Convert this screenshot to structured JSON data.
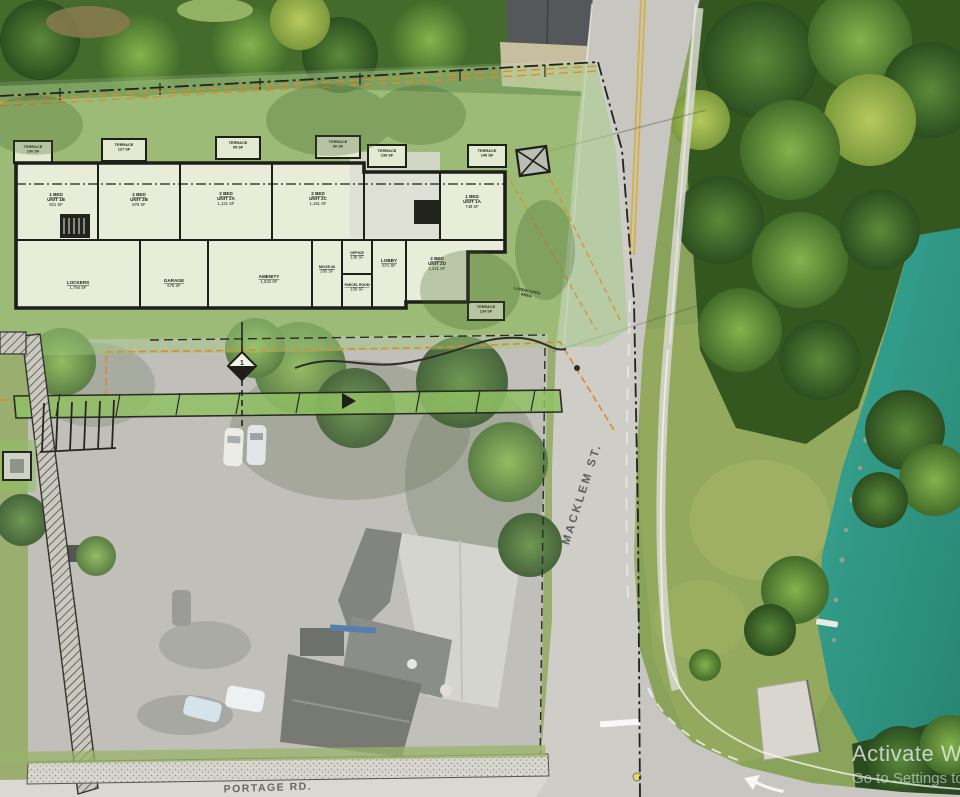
{
  "scene": {
    "description": "Aerial drone view of a riverside site with an architectural site-plan / floor-plan overlay",
    "streets": {
      "macklem": "MACKLEM ST.",
      "portage": "PORTAGE RD."
    },
    "watermark": {
      "line1": "Activate Win",
      "line2": "Go to Settings to"
    }
  },
  "plan": {
    "terraces": [
      {
        "name": "TERRACE",
        "area": "106 SF"
      },
      {
        "name": "TERRACE",
        "area": "127 SF"
      },
      {
        "name": "TERRACE",
        "area": "95 SF"
      },
      {
        "name": "TERRACE",
        "area": "96 SF"
      },
      {
        "name": "TERRACE",
        "area": "139 SF"
      },
      {
        "name": "TERRACE",
        "area": "140 SF"
      },
      {
        "name": "TERRACE",
        "area": "134 SF"
      }
    ],
    "units": [
      {
        "l1": "1 BED",
        "l2": "UNIT 1B",
        "l3": "921 SF"
      },
      {
        "l1": "2 BED",
        "l2": "UNIT 2B",
        "l3": "879 SF"
      },
      {
        "l1": "2 BED",
        "l2": "UNIT 2A",
        "l3": "1,121 SF"
      },
      {
        "l1": "2 BED",
        "l2": "UNIT 2C",
        "l3": "1,161 SF"
      },
      {
        "l1": "1 BED",
        "l2": "UNIT 1A",
        "l3": "748 SF"
      },
      {
        "l1": "2 BED",
        "l2": "UNIT 2D",
        "l3": "1,221 SF"
      }
    ],
    "rooms": [
      {
        "name": "LOCKERS",
        "area": "1,794 SF"
      },
      {
        "name": "GARAGE",
        "area": "678 SF"
      },
      {
        "name": "AMENITY",
        "area": "1,533 SF"
      },
      {
        "name": "MOVE-IN",
        "area": "265 SF"
      },
      {
        "name": "OFFICE",
        "area": "138 SF"
      },
      {
        "name": "PARCEL ROOM",
        "area": "159 SF"
      },
      {
        "name": "LOBBY",
        "area": "571 SF"
      }
    ],
    "landscaped_note": {
      "l1": "LANDSCAPED",
      "l2": "AREA"
    },
    "section_marker": "1"
  },
  "colors": {
    "water": "#2f9e8c",
    "overlay_green": "#9fc87e",
    "setback_orange": "#e08a28",
    "plan_line": "#222220",
    "road": "#c7c6c0",
    "roof_dark": "#63675f",
    "roof_light": "#cfcfc8",
    "grass": "#8aa35a"
  }
}
